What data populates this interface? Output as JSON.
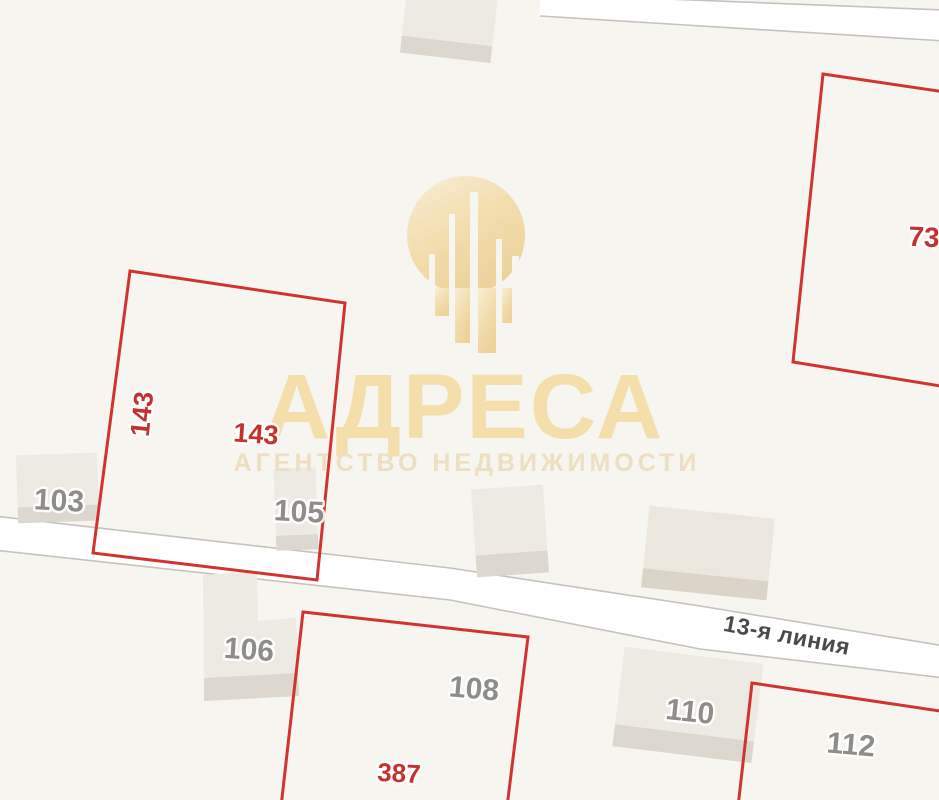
{
  "canvas": {
    "width": 939,
    "height": 800,
    "background": "#f7f5f0"
  },
  "colors": {
    "background": "#f7f5f0",
    "road_fill": "#ffffff",
    "road_border": "#c6c3bd",
    "building_fill": "#edeae3",
    "building_shadow": "#dcd8d0",
    "building_label": "#8f8d8a",
    "street_label": "#4a4a48",
    "parcel_stroke": "#d13430",
    "parcel_label": "#c2322e",
    "watermark_gold": "#f4deab",
    "watermark_tagline": "#eddfc2"
  },
  "watermark": {
    "brand": "АДРЕСА",
    "tagline": "АГЕНТСТВО НЕДВИЖИМОСТИ",
    "logo": "buildings-droplet-icon"
  },
  "street": {
    "name": "13-я линия"
  },
  "parcel_labels": {
    "p143_side": "143",
    "p143": "143",
    "p387": "387",
    "p73": "73"
  },
  "building_labels": {
    "b103": "103",
    "b105": "105",
    "b106": "106",
    "b110": "110"
  },
  "lot_labels": {
    "l108": "108",
    "l112": "112"
  }
}
